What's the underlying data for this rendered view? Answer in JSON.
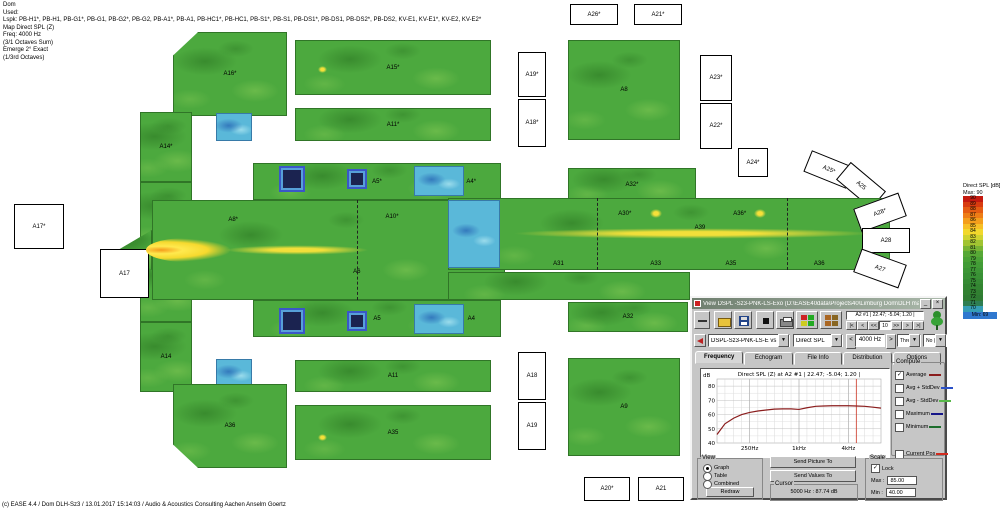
{
  "header": {
    "lines": [
      "Dom",
      "Used:",
      "Lspk: PB-H1*, PB-H1, PB-G1*, PB-G1, PB-G2*, PB-G2, PB-A1*, PB-A1, PB-HC1*, PB-HC1, PB-S1*, PB-S1, PB-DS1*, PB-DS1, PB-DS2*, PB-DS2, KV-E1, KV-E1*, KV-E2, KV-E2*",
      "Map Direct SPL (Z)",
      "Freq: 4000 Hz",
      "(3/1 Octaves Sum)",
      "Emerge 2° Exact",
      "(1/3rd Octaves)"
    ]
  },
  "footer": {
    "text": "(c) EASE 4.4  / Dom DLH-Sz3 / 13.01.2017 15:14:03 / Audio & Acoustics Consulting Aachen Anselm Goertz"
  },
  "legend": {
    "title": "Direct SPL [dB]",
    "max_label": "Max: 90",
    "min_label": "Min: 69",
    "min_color": "#2f78cf",
    "entries": [
      {
        "v": "90",
        "c": "#c41a10"
      },
      {
        "v": "89",
        "c": "#d83c10"
      },
      {
        "v": "88",
        "c": "#e55c12"
      },
      {
        "v": "87",
        "c": "#ee7d16"
      },
      {
        "v": "86",
        "c": "#f49e1c"
      },
      {
        "v": "85",
        "c": "#f7bf26"
      },
      {
        "v": "84",
        "c": "#f2d82c"
      },
      {
        "v": "83",
        "c": "#cfd32f"
      },
      {
        "v": "82",
        "c": "#a1c432"
      },
      {
        "v": "81",
        "c": "#77b434"
      },
      {
        "v": "80",
        "c": "#57a836"
      },
      {
        "v": "79",
        "c": "#4aa236"
      },
      {
        "v": "78",
        "c": "#429c36"
      },
      {
        "v": "77",
        "c": "#3d9636"
      },
      {
        "v": "76",
        "c": "#399135"
      },
      {
        "v": "75",
        "c": "#368b34"
      },
      {
        "v": "74",
        "c": "#338532"
      },
      {
        "v": "73",
        "c": "#318031"
      },
      {
        "v": "72",
        "c": "#2f7b33"
      },
      {
        "v": "71",
        "c": "#2e7e52"
      },
      {
        "v": "70",
        "c": "#359eb5"
      }
    ]
  },
  "map": {
    "zones": [
      {
        "l": "A16*",
        "x": 173,
        "y": 32,
        "w": 114,
        "h": 84,
        "t": "g",
        "clip": "tl"
      },
      {
        "l": "A15*",
        "x": 295,
        "y": 40,
        "w": 196,
        "h": 55,
        "t": "g"
      },
      {
        "x": 216,
        "y": 113,
        "w": 36,
        "h": 28,
        "t": "cyan"
      },
      {
        "l": "A11*",
        "x": 295,
        "y": 108,
        "w": 196,
        "h": 33,
        "t": "g"
      },
      {
        "l": "A14*",
        "x": 140,
        "y": 112,
        "w": 52,
        "h": 70,
        "t": "g"
      },
      {
        "l": "A13*",
        "x": 140,
        "y": 182,
        "w": 52,
        "h": 68,
        "t": "g"
      },
      {
        "l": "A13",
        "x": 140,
        "y": 250,
        "w": 52,
        "h": 72,
        "t": "g"
      },
      {
        "l": "A14",
        "x": 140,
        "y": 322,
        "w": 52,
        "h": 70,
        "t": "g"
      },
      {
        "x": 118,
        "y": 230,
        "w": 34,
        "h": 40,
        "t": "g",
        "clip": "apse"
      },
      {
        "l": "A5*",
        "x": 253,
        "y": 163,
        "w": 248,
        "h": 37,
        "t": "g",
        "ls": [
          {
            "t": "A4*",
            "x": 88,
            "y": 50
          }
        ]
      },
      {
        "x": 152,
        "y": 200,
        "w": 353,
        "h": 100,
        "t": "hot",
        "ls": [
          {
            "t": "A8*",
            "x": 23,
            "y": 20
          },
          {
            "t": "A10*",
            "x": 68,
            "y": 17
          },
          {
            "t": "A6",
            "x": 58,
            "y": 72
          }
        ]
      },
      {
        "l": "A5",
        "x": 253,
        "y": 300,
        "w": 248,
        "h": 37,
        "t": "g",
        "ls": [
          {
            "t": "A4",
            "x": 88,
            "y": 50
          }
        ]
      },
      {
        "x": 279,
        "y": 166,
        "w": 26,
        "h": 26,
        "t": "navy"
      },
      {
        "x": 347,
        "y": 169,
        "w": 20,
        "h": 20,
        "t": "navy"
      },
      {
        "x": 414,
        "y": 166,
        "w": 50,
        "h": 30,
        "t": "cyan"
      },
      {
        "x": 279,
        "y": 308,
        "w": 26,
        "h": 26,
        "t": "navy"
      },
      {
        "x": 347,
        "y": 311,
        "w": 20,
        "h": 20,
        "t": "navy"
      },
      {
        "x": 414,
        "y": 304,
        "w": 50,
        "h": 30,
        "t": "cyan"
      },
      {
        "x": 216,
        "y": 359,
        "w": 36,
        "h": 28,
        "t": "cyan"
      },
      {
        "l": "A11",
        "x": 295,
        "y": 360,
        "w": 196,
        "h": 32,
        "t": "g"
      },
      {
        "l": "A35",
        "x": 295,
        "y": 405,
        "w": 196,
        "h": 55,
        "t": "g"
      },
      {
        "l": "A36",
        "x": 173,
        "y": 384,
        "w": 114,
        "h": 84,
        "t": "g",
        "clip": "bl"
      },
      {
        "l": "A17*",
        "x": 14,
        "y": 204,
        "w": 48,
        "h": 43,
        "t": "out"
      },
      {
        "l": "A17",
        "x": 100,
        "y": 249,
        "w": 47,
        "h": 47,
        "t": "out"
      },
      {
        "l": "A26*",
        "x": 570,
        "y": 4,
        "w": 46,
        "h": 19,
        "t": "out"
      },
      {
        "l": "A21*",
        "x": 634,
        "y": 4,
        "w": 46,
        "h": 19,
        "t": "out"
      },
      {
        "l": "A19*",
        "x": 518,
        "y": 52,
        "w": 26,
        "h": 43,
        "t": "out"
      },
      {
        "l": "A18*",
        "x": 518,
        "y": 99,
        "w": 26,
        "h": 46,
        "t": "out"
      },
      {
        "l": "A8",
        "x": 568,
        "y": 40,
        "w": 112,
        "h": 100,
        "t": "g"
      },
      {
        "l": "A23*",
        "x": 700,
        "y": 55,
        "w": 30,
        "h": 44,
        "t": "out"
      },
      {
        "l": "A22*",
        "x": 700,
        "y": 103,
        "w": 30,
        "h": 44,
        "t": "out"
      },
      {
        "l": "A32*",
        "x": 568,
        "y": 168,
        "w": 128,
        "h": 33,
        "t": "g"
      },
      {
        "l": "A24*",
        "x": 738,
        "y": 148,
        "w": 28,
        "h": 27,
        "t": "out"
      },
      {
        "l": "A25*",
        "x": 806,
        "y": 158,
        "w": 44,
        "h": 21,
        "t": "out",
        "r": 22
      },
      {
        "l": "A25",
        "x": 838,
        "y": 174,
        "w": 44,
        "h": 21,
        "t": "out",
        "r": 40
      },
      {
        "x": 448,
        "y": 198,
        "w": 442,
        "h": 72,
        "t": "hot",
        "ls": [
          {
            "t": "A30*",
            "x": 40,
            "y": 22
          },
          {
            "t": "A36*",
            "x": 66,
            "y": 22
          },
          {
            "t": "A39",
            "x": 57,
            "y": 42
          },
          {
            "t": "A31",
            "x": 25,
            "y": 92
          },
          {
            "t": "A33",
            "x": 47,
            "y": 92
          },
          {
            "t": "A35",
            "x": 64,
            "y": 92
          },
          {
            "t": "A36",
            "x": 84,
            "y": 92
          }
        ]
      },
      {
        "x": 448,
        "y": 200,
        "w": 52,
        "h": 68,
        "t": "cyan"
      },
      {
        "x": 448,
        "y": 272,
        "w": 242,
        "h": 28,
        "t": "g"
      },
      {
        "l": "A32",
        "x": 568,
        "y": 302,
        "w": 120,
        "h": 30,
        "t": "g"
      },
      {
        "l": "A28*",
        "x": 856,
        "y": 200,
        "w": 46,
        "h": 23,
        "t": "out",
        "r": -20
      },
      {
        "l": "A28",
        "x": 862,
        "y": 228,
        "w": 46,
        "h": 23,
        "t": "out",
        "r": 0
      },
      {
        "l": "A27",
        "x": 856,
        "y": 256,
        "w": 46,
        "h": 23,
        "t": "out",
        "r": 20
      },
      {
        "l": "A18",
        "x": 518,
        "y": 352,
        "w": 26,
        "h": 46,
        "t": "out"
      },
      {
        "l": "A19",
        "x": 518,
        "y": 402,
        "w": 26,
        "h": 46,
        "t": "out"
      },
      {
        "l": "A9",
        "x": 568,
        "y": 358,
        "w": 112,
        "h": 98,
        "t": "g"
      },
      {
        "l": "A22",
        "x": 700,
        "y": 356,
        "w": 30,
        "h": 74,
        "t": "out"
      },
      {
        "l": "A20*",
        "x": 584,
        "y": 477,
        "w": 44,
        "h": 22,
        "t": "out"
      },
      {
        "l": "A21",
        "x": 638,
        "y": 477,
        "w": 44,
        "h": 22,
        "t": "out"
      }
    ],
    "hotspots": [
      {
        "t": "flame",
        "x": 146,
        "y": 238,
        "w": 84,
        "h": 24
      },
      {
        "t": "streak",
        "x": 222,
        "y": 245,
        "w": 150,
        "h": 10
      },
      {
        "t": "streak",
        "x": 505,
        "y": 228,
        "w": 375,
        "h": 11
      },
      {
        "t": "dot",
        "x": 650,
        "y": 209,
        "w": 12,
        "h": 9
      },
      {
        "t": "dot",
        "x": 754,
        "y": 209,
        "w": 12,
        "h": 9
      },
      {
        "t": "dot",
        "x": 318,
        "y": 66,
        "w": 9,
        "h": 7
      },
      {
        "t": "dot",
        "x": 318,
        "y": 434,
        "w": 9,
        "h": 7
      }
    ],
    "dashlines": [
      {
        "x": 357,
        "y": 200,
        "h": 100
      },
      {
        "x": 597,
        "y": 198,
        "h": 72
      },
      {
        "x": 787,
        "y": 198,
        "h": 72
      }
    ]
  },
  "dialog": {
    "title": "View DSPL -Sz3-PNK-LS-Exo (D:\\EASE40data\\Projects40\\Limburg Dom\\DLH mapping 4000 Hz)",
    "min_button": "_",
    "close_button": "×",
    "toolbar": {
      "position": "A2 #1  | 22.47; -5.04; 1.20 |",
      "nav": [
        {
          "t": "|<"
        },
        {
          "t": "<"
        },
        {
          "t": "<<"
        },
        {
          "t": "10",
          "edit": true
        },
        {
          "t": ">>"
        },
        {
          "t": ">"
        },
        {
          "t": ">|"
        }
      ]
    },
    "combos": {
      "file": "DSPL-Sz3-PNK-LS-E vs DSPL-Sz",
      "quantity": "Direct SPL",
      "freq_prev": "<",
      "freq_value": "4000 Hz",
      "freq_next": ">",
      "bandwidth": "Three Octave",
      "weighting": "No (Z) Weight"
    },
    "tabs": [
      "Frequency",
      "Echogram",
      "File Info",
      "Distribution",
      "Options"
    ],
    "active_tab": "Frequency",
    "compute": {
      "title": "Compute",
      "items": [
        {
          "label": "Average",
          "checked": true,
          "color": "#8b1d1d"
        },
        {
          "label": "Avg + StdDev",
          "checked": false,
          "color": "#2a50c8"
        },
        {
          "label": "Avg - StdDev",
          "checked": false,
          "color": "#58b84a"
        },
        {
          "label": "Maximum",
          "checked": false,
          "color": "#161689"
        },
        {
          "label": "Minimum",
          "checked": false,
          "color": "#1d6e2d"
        },
        {
          "label": "Current Pos",
          "checked": false,
          "color": "#d22b1e",
          "gap": true
        }
      ]
    },
    "view": {
      "title": "View",
      "options": [
        "Graph",
        "Table",
        "Combined"
      ],
      "selected": "Graph",
      "redraw_label": "Redraw"
    },
    "send_picture_label": "Send Picture To",
    "send_values_label": "Send Values To",
    "cursor": {
      "title": "Cursor",
      "value": "5000 Hz :  87.74 dB"
    },
    "scale": {
      "title": "Scale",
      "lock_label": "Lock",
      "lock_checked": true,
      "max_label": "Max :",
      "max_value": "85.00",
      "min_label": "Min :",
      "min_value": "40.00"
    },
    "chart_data": {
      "type": "line",
      "title": "Direct SPL (Z) at A2 #1  | 22.47; -5.04; 1.20 |",
      "ylabel": "dB",
      "ylim": [
        40,
        85
      ],
      "yticks": [
        80,
        70,
        60,
        50,
        40
      ],
      "xlim_hz": [
        100,
        10000
      ],
      "xticks": [
        {
          "f": 250,
          "label": "250Hz"
        },
        {
          "f": 1000,
          "label": "1kHz"
        },
        {
          "f": 4000,
          "label": "4kHz"
        }
      ],
      "grid_freqs": [
        125,
        160,
        200,
        250,
        315,
        400,
        500,
        630,
        800,
        1000,
        1250,
        1600,
        2000,
        2500,
        3150,
        4000,
        5000,
        6300,
        8000
      ],
      "series": [
        {
          "name": "Average",
          "color": "#8b1d1d",
          "x": [
            100,
            125,
            160,
            200,
            250,
            315,
            400,
            500,
            630,
            800,
            1000,
            1250,
            1600,
            2000,
            2500,
            3150,
            4000,
            5000,
            6300,
            8000,
            10000
          ],
          "values": [
            46,
            53.5,
            57.5,
            60,
            61.5,
            62.5,
            63.2,
            63.8,
            64,
            64,
            63.6,
            64.8,
            65.8,
            66,
            66.2,
            66.2,
            66.2,
            66,
            65.8,
            65.2,
            64.5
          ]
        }
      ],
      "cursor_hz": 5000,
      "cursor_color": "#cc3322"
    }
  }
}
